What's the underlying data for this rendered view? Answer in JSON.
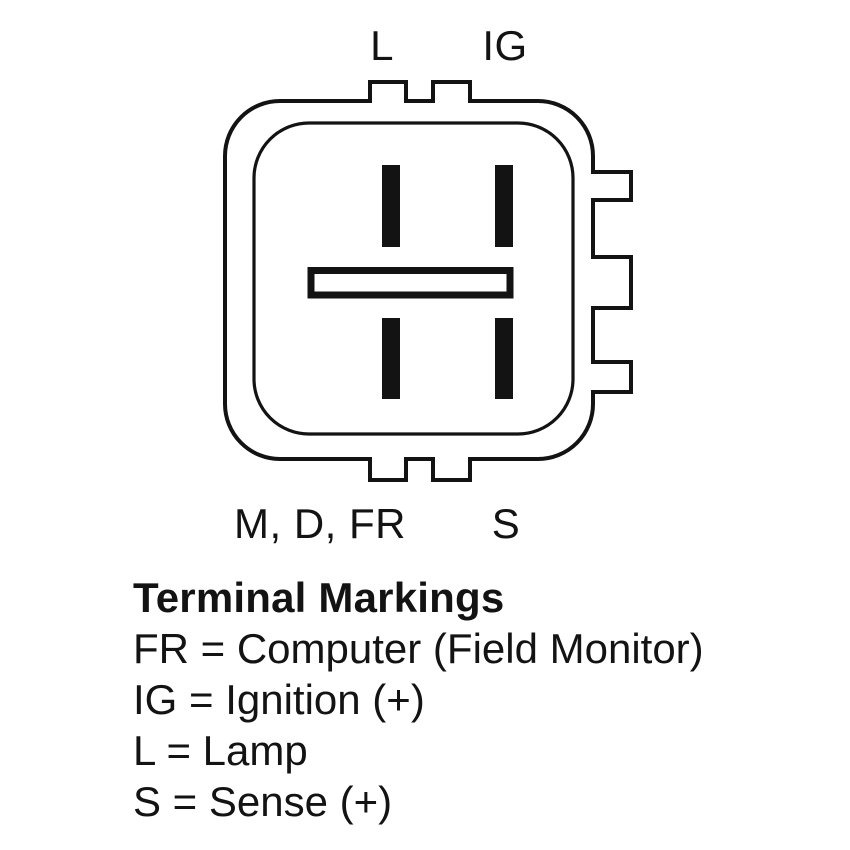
{
  "figure": {
    "connector": {
      "pin_labels": {
        "top_left": "L",
        "top_right": "IG",
        "bottom_left": "M, D, FR",
        "bottom_right": "S"
      }
    },
    "legend": {
      "title": "Terminal Markings",
      "entries": [
        "FR = Computer (Field Monitor)",
        "IG = Ignition (+)",
        "L = Lamp",
        "S = Sense (+)"
      ]
    },
    "colors": {
      "line": "#131313",
      "background": "#ffffff"
    }
  }
}
